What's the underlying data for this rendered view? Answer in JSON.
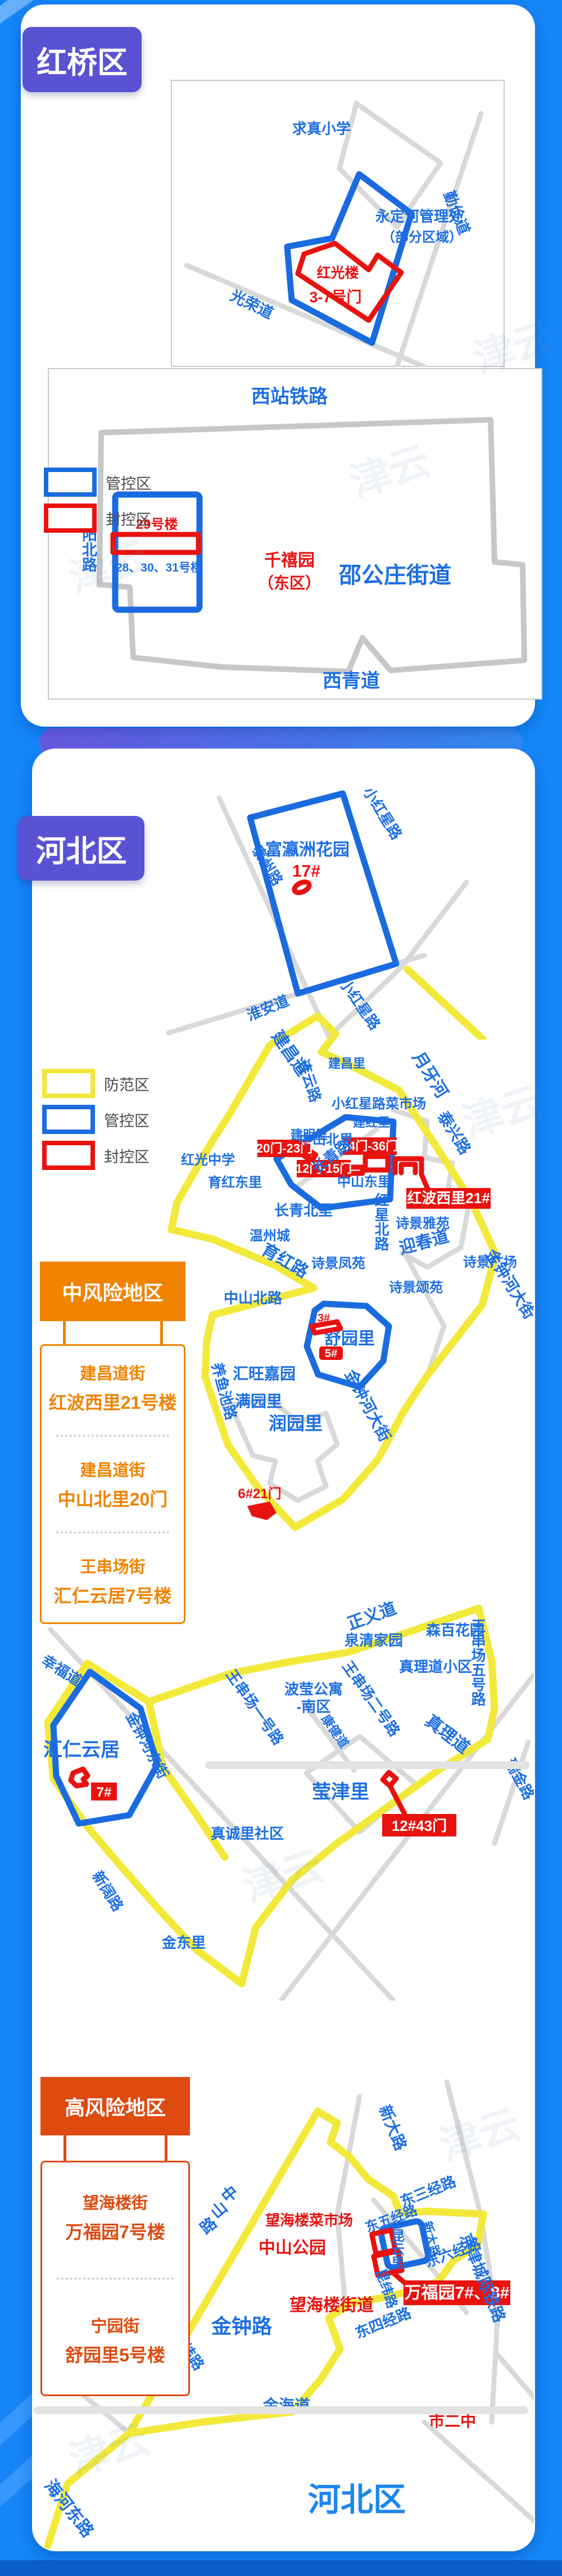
{
  "page": {
    "watermark": "津云"
  },
  "colors": {
    "background": "#1585f8",
    "badge": "#5953d4",
    "prevention_yellow": "#f2e93a",
    "control_blue": "#1a6be0",
    "sealed_red": "#e8120f",
    "medium_risk_orange": "#f08300",
    "high_risk_red": "#df4a10"
  },
  "hongqiao": {
    "badge": "红桥区",
    "map1": {
      "school": "求真小学",
      "yongdinghe_1": "永定河管理处",
      "yongdinghe_2": "（部分区域）",
      "hongguanglou": "红光楼",
      "gates": "3-7号门",
      "guangrong_rd": "光荣道",
      "qinjian_rd": "勤俭道"
    },
    "legend": {
      "guankong": "管控区",
      "fengkong": "封控区"
    },
    "map2": {
      "railway": "西站铁路",
      "xianyang_rd": "咸阳北路",
      "bldg29": "29号楼",
      "bldg283031": "28、30、31号楼",
      "qianxiyuan_1": "千禧园",
      "qianxiyuan_2": "（东区）",
      "shaogongzhuang": "邵公庄街道",
      "xiqing_rd": "西青道"
    }
  },
  "hebei": {
    "badge": "河北区",
    "legend": {
      "fangfan": "防范区",
      "guankong": "管控区",
      "fengkong": "封控区"
    },
    "mapA": {
      "xiaohongxing_top": "小红星路",
      "fuyingzhou": "富瀛洲花园",
      "b17": "17#",
      "taizhou_rd": "泰州路",
      "huaian_rd": "淮安道",
      "xiaohongxing_bottom": "小红星路"
    },
    "mapB": {
      "jianchang_rd": "建昌道",
      "lianyun_rd": "连云路",
      "jianchangli": "建昌里",
      "market": "小红星路菜市场",
      "yueyahe": "月牙河",
      "jianmingli": "建明里",
      "changqing_rd": "长青路",
      "jianhongli": "建红里",
      "taixing_rd": "泰兴路",
      "zhongshanbeili": "中山北里",
      "gate2023": "20门-23门",
      "gate3436": "34门-36门",
      "gate1215": "12门-15门",
      "hongguang_school": "红光中学",
      "yuhongdongli": "育红东里",
      "zhongshandongli": "中山东里",
      "hongboxili": "红波西里21#",
      "hongxing_rd": "红星北路",
      "changqingbeili": "长青北里",
      "shijingyayuan": "诗景雅苑",
      "wenzhoucheng": "温州城",
      "yingchun_rd": "迎春道",
      "yuhong_rd": "育红路",
      "shijingfengyuan": "诗景凤苑",
      "shijingguangchang": "诗景广场",
      "shijingsongyuan": "诗景颂苑",
      "jinzhonghe_st": "金钟河大街",
      "zhongshanbei_rd": "中山北路",
      "yangyuchi_rd": "养鱼池路",
      "huiwangjiayuan": "汇旺嘉园",
      "shuyuanli": "舒园里",
      "b3": "3#",
      "b5": "5#",
      "manyuanli": "满园里",
      "runyuanli": "润园里",
      "gate621": "6#21门"
    },
    "medium_risk": {
      "title": "中风险地区",
      "items": [
        {
          "street": "建昌道街",
          "building": "红波西里21号楼"
        },
        {
          "street": "建昌道街",
          "building": "中山北里20门"
        },
        {
          "street": "王串场街",
          "building": "汇仁云居7号楼"
        }
      ]
    },
    "mapC": {
      "zhengyi_rd": "正义道",
      "wcc5_rd": "王串场五号路",
      "senbaihuayuan": "森百花园",
      "quanqingjiayuan": "泉清家园",
      "xingfu_rd": "幸福道",
      "jinzhonghedong_st": "金钟河东街",
      "huirenyunju": "汇仁云居",
      "b7": "7#",
      "xinkuo_rd": "新阔路",
      "wcc1_rd": "王串场一号路",
      "boying_1": "波莹公寓",
      "boying_2": "-南区",
      "wcc2_rd": "王串场二号路",
      "kangjian_rd": "康健道",
      "zhenlidao_xq": "真理道小区",
      "zhenli_rd": "真理道",
      "ruijin_rd": "瑞金路",
      "yingjinli": "莹津里",
      "gate1243": "12#43门",
      "zhenchengli": "真诚里社区",
      "jindongli": "金东里"
    },
    "high_risk": {
      "title": "高风险地区",
      "items": [
        {
          "street": "望海楼街",
          "building": "万福园7号楼"
        },
        {
          "street": "宁园街",
          "building": "舒园里5号楼"
        }
      ]
    },
    "mapD": {
      "xinda_rd_1": "新大路",
      "dong3_rd": "东三经路",
      "jingjin_rail": "京津城际铁路",
      "dong4_rd": "东四经路",
      "dong5_rd": "东五经路",
      "kunyunli": "昆云里",
      "xinda_rd_2": "新大路",
      "dong6_rd": "东六经路",
      "kunwei_rd": "昆纬路",
      "wanfuyuan_badge": "万福园7#、8#",
      "caishichang": "望海楼菜市场",
      "zhongshan_park": "中山公园",
      "zhongshan_rd_chars": [
        "中",
        "山",
        "路"
      ],
      "jinzhong_rd": "金钟路",
      "jinwei_rd": "金纬路",
      "jinhai_rd": "金海道",
      "wanghailou_jd": "望海楼街道",
      "shierzhong": "市二中",
      "hebei_big": "河北区",
      "haihedong_rd": "海河东路"
    }
  }
}
